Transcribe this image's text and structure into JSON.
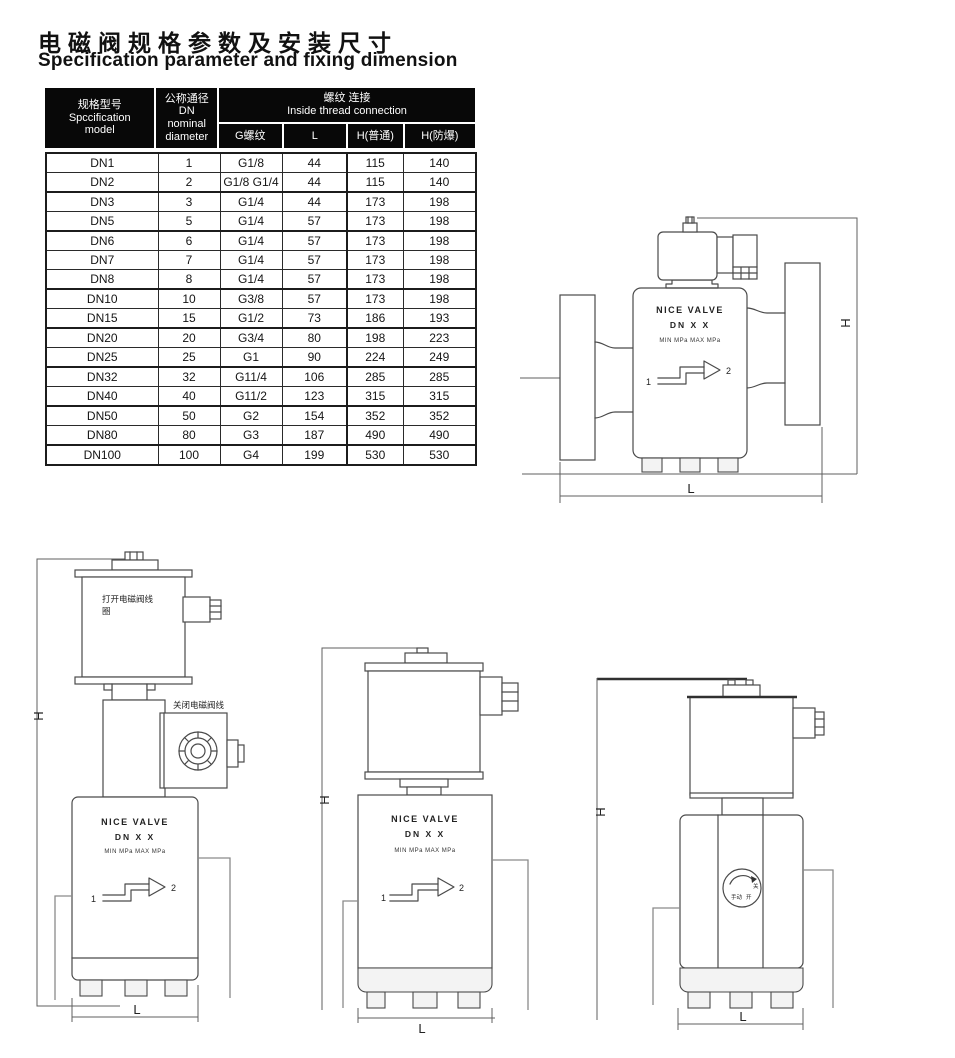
{
  "page": {
    "title_zh": "电磁阀规格参数及安装尺寸",
    "title_en": "Specification parameter and fixing dimension"
  },
  "table": {
    "header": {
      "model_zh": "规格型号",
      "model_en1": "Spccification",
      "model_en2": "model",
      "dn_zh": "公称通径",
      "dn_code": "DN",
      "dn_en1": "nominal",
      "dn_en2": "diameter",
      "group_zh": "螺纹 连接",
      "group_en": "Inside thread connection",
      "sub": [
        "G螺纹",
        "L",
        "H(普通)",
        "H(防爆)"
      ]
    },
    "rows": [
      {
        "model": "DN1",
        "dn": "1",
        "g": "G1/8",
        "l": "44",
        "h_normal": "115",
        "h_ex": "140",
        "group_end": false
      },
      {
        "model": "DN2",
        "dn": "2",
        "g": "G1/8 G1/4",
        "l": "44",
        "h_normal": "115",
        "h_ex": "140",
        "group_end": true
      },
      {
        "model": "DN3",
        "dn": "3",
        "g": "G1/4",
        "l": "44",
        "h_normal": "173",
        "h_ex": "198",
        "group_end": false
      },
      {
        "model": "DN5",
        "dn": "5",
        "g": "G1/4",
        "l": "57",
        "h_normal": "173",
        "h_ex": "198",
        "group_end": true
      },
      {
        "model": "DN6",
        "dn": "6",
        "g": "G1/4",
        "l": "57",
        "h_normal": "173",
        "h_ex": "198",
        "group_end": false
      },
      {
        "model": "DN7",
        "dn": "7",
        "g": "G1/4",
        "l": "57",
        "h_normal": "173",
        "h_ex": "198",
        "group_end": false
      },
      {
        "model": "DN8",
        "dn": "8",
        "g": "G1/4",
        "l": "57",
        "h_normal": "173",
        "h_ex": "198",
        "group_end": true
      },
      {
        "model": "DN10",
        "dn": "10",
        "g": "G3/8",
        "l": "57",
        "h_normal": "173",
        "h_ex": "198",
        "group_end": false
      },
      {
        "model": "DN15",
        "dn": "15",
        "g": "G1/2",
        "l": "73",
        "h_normal": "186",
        "h_ex": "193",
        "group_end": true
      },
      {
        "model": "DN20",
        "dn": "20",
        "g": "G3/4",
        "l": "80",
        "h_normal": "198",
        "h_ex": "223",
        "group_end": false
      },
      {
        "model": "DN25",
        "dn": "25",
        "g": "G1",
        "l": "90",
        "h_normal": "224",
        "h_ex": "249",
        "group_end": true
      },
      {
        "model": "DN32",
        "dn": "32",
        "g": "G11/4",
        "l": "106",
        "h_normal": "285",
        "h_ex": "285",
        "group_end": false
      },
      {
        "model": "DN40",
        "dn": "40",
        "g": "G11/2",
        "l": "123",
        "h_normal": "315",
        "h_ex": "315",
        "group_end": true
      },
      {
        "model": "DN50",
        "dn": "50",
        "g": "G2",
        "l": "154",
        "h_normal": "352",
        "h_ex": "352",
        "group_end": false
      },
      {
        "model": "DN80",
        "dn": "80",
        "g": "G3",
        "l": "187",
        "h_normal": "490",
        "h_ex": "490",
        "group_end": true
      },
      {
        "model": "DN100",
        "dn": "100",
        "g": "G4",
        "l": "199",
        "h_normal": "530",
        "h_ex": "530",
        "group_end": false
      }
    ]
  },
  "diagrams": {
    "dim_height": "H",
    "dim_length": "L",
    "port_in": "1",
    "port_out": "2",
    "body_line1": "NICE VALVE",
    "body_line2": "DN X X",
    "body_line3": "MIN MPa MAX MPa",
    "open_coil_line1": "打开电磁阀线",
    "open_coil_line2": "圈",
    "close_coil_line1": "关闭电磁阀线",
    "close_coil_line2": "圈",
    "dial_manual": "手动",
    "dial_open": "开",
    "dial_close": "关"
  }
}
